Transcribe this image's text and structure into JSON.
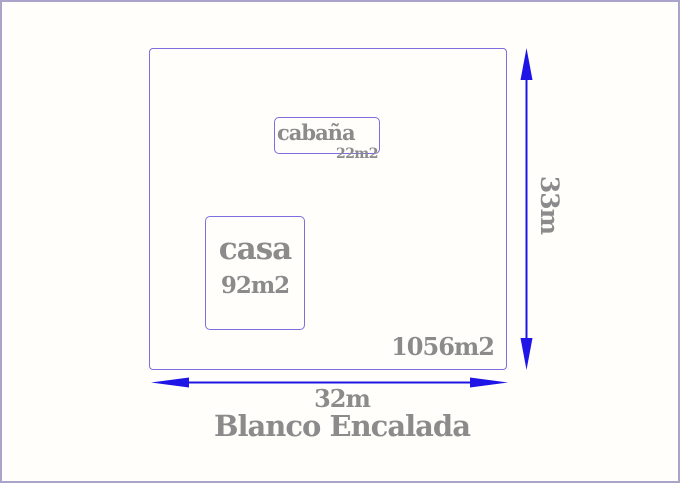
{
  "page": {
    "title": "Blanco Encalada"
  },
  "lot": {
    "area_label": "1056m2",
    "width_label": "32m",
    "height_label": "33m"
  },
  "buildings": {
    "casa": {
      "label": "casa",
      "area_label": "92m2"
    },
    "cabana": {
      "label": "cabaña",
      "area_label": "22m2"
    }
  },
  "icons": {
    "width_arrow": "horizontal-double-arrow",
    "height_arrow": "vertical-double-arrow"
  },
  "colors": {
    "outline_purple": "#7d6fde",
    "arrow_blue": "#1f15e6",
    "text_gray": "#8b8b8b",
    "frame_border": "#aaa4cb",
    "background": "#fffefb"
  }
}
